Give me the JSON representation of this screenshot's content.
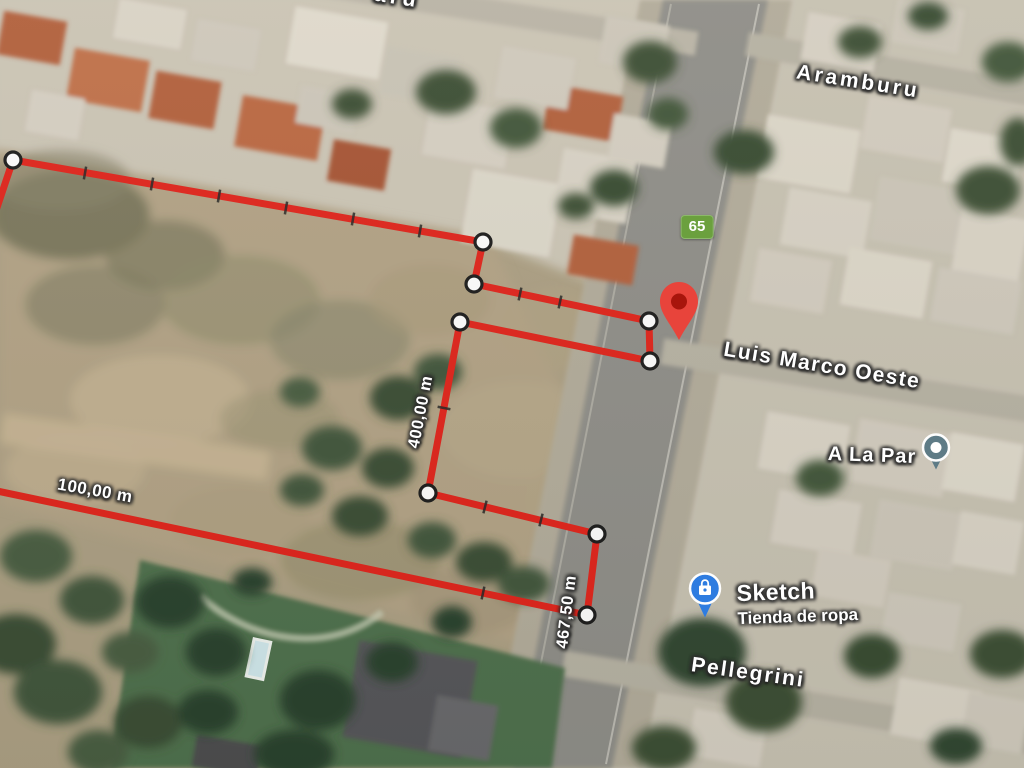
{
  "map_type": "satellite",
  "streets": {
    "aramburu": "Aramburu",
    "luis_marco_oeste": "Luis Marco Oeste",
    "pellegrini": "Pellegrini",
    "top_edge_partial": "aru"
  },
  "route_badge": {
    "number": "65"
  },
  "pois": {
    "a_la_par": {
      "label": "A La Par"
    },
    "sketch": {
      "name": "Sketch",
      "category": "Tienda de ropa"
    }
  },
  "parcel": {
    "measurements": {
      "west_side": "400,00 m",
      "south_side": "100,00 m",
      "east_side": "467,50 m"
    }
  },
  "colors": {
    "boundary_red": "#df241c",
    "route_badge_green": "#6ba03e",
    "location_pin_red": "#e8443b",
    "sketch_pin_blue": "#2e7ce0",
    "a_la_par_pin_teal": "#5e7b86"
  }
}
